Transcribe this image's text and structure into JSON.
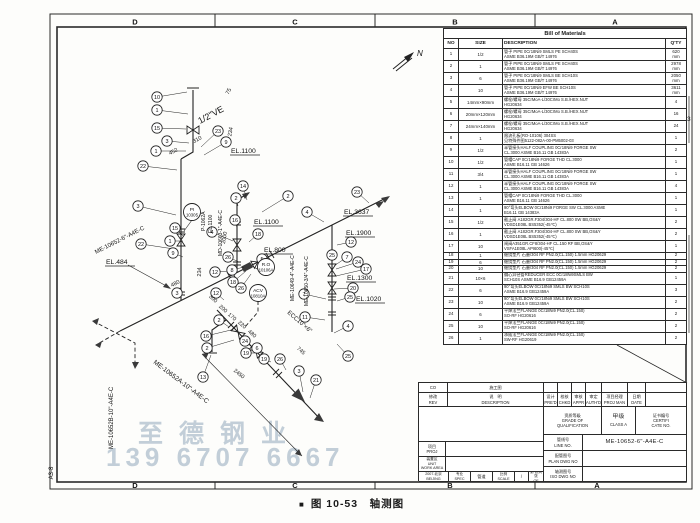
{
  "sheet": {
    "zones_top": [
      "D",
      "C",
      "B",
      "A"
    ],
    "zones_bottom": [
      "D",
      "C",
      "B",
      "A"
    ],
    "sheet_label": "A3-8",
    "north_label": "N",
    "caption_marker": "■",
    "caption": "图 10-53　轴测图"
  },
  "watermark": {
    "line1": "至德钢业",
    "line2": "139 6707 6667",
    "color": "#9eb2c2"
  },
  "bom": {
    "title": "Bill  of  Materials",
    "headers": [
      "NO",
      "SIZE",
      "DESCRIPTION",
      "Q'TY"
    ],
    "rows": [
      {
        "no": "1",
        "size": "1/2",
        "d1": "管子 PIPE 0Cr18Ni9 SMLS PE SCH40S",
        "d2": "ASME B36.19M GB/T 14976",
        "qty": "620",
        "u": "mm"
      },
      {
        "no": "2",
        "size": "1",
        "d1": "管子 PIPE 0Cr18Ni9 SMLS PE SCH40S",
        "d2": "ASME B36.19M GB/T 14976",
        "qty": "2978",
        "u": "mm"
      },
      {
        "no": "3",
        "size": "6",
        "d1": "管子 PIPE 0Cr18Ni9 SMLS BE SCH10S",
        "d2": "ASME B36.19M GB/T 14976",
        "qty": "2050",
        "u": "mm"
      },
      {
        "no": "4",
        "size": "10",
        "d1": "管子 PIPE 0Cr18Ni9 EFW BE SCH10S",
        "d2": "ASME B36.19M GB/T 14976",
        "qty": "3611",
        "u": "mm"
      },
      {
        "no": "5",
        "size": "14mm×90mm",
        "d1": "螺栓/螺母 35CrMoA-L/30CrMo S.B./HEX.NUT",
        "d2": "HG20634",
        "qty": "4",
        "u": ""
      },
      {
        "no": "6",
        "size": "20mm×120mm",
        "d1": "螺栓/螺母 35CrMoA-L/30CrMo S.B./HEX.NUT",
        "d2": "HG20634",
        "qty": "16",
        "u": ""
      },
      {
        "no": "7",
        "size": "24mm×140mm",
        "d1": "螺栓/螺母 35CrMoA-L/30CrMo S.B./HEX.NUT",
        "d2": "HG20634",
        "qty": "24",
        "u": ""
      },
      {
        "no": "8",
        "size": "1",
        "d1": "限流孔板(RO-10106) 304SS",
        "d2": "见特殊件图5122-082A-00-PM5002-03",
        "qty": "1",
        "u": ""
      },
      {
        "no": "9",
        "size": "1/2",
        "d1": "半管接头HALF COUPLING 0Cr18Ni9 FORGE SW",
        "d2": "CL.3000  ASME B16.11 GB 14383A",
        "qty": "2",
        "u": ""
      },
      {
        "no": "10",
        "size": "1/2",
        "d1": "管帽CAP 0Cr18Ni9 FORGE THD CL.3000",
        "d2": "ASME B16.11 GB 14626",
        "qty": "1",
        "u": ""
      },
      {
        "no": "11",
        "size": "3/4",
        "d1": "半管接头HALF COUPLING 0Cr18Ni9 FORGE SW",
        "d2": "CL.3000  ASME B16.11 GB 14383A",
        "qty": "1",
        "u": ""
      },
      {
        "no": "12",
        "size": "1",
        "d1": "半管接头HALF COUPLING 0Cr18Ni9 FORGE SW",
        "d2": "CL.3000  ASME B16.11 GB 14383A",
        "qty": "4",
        "u": ""
      },
      {
        "no": "13",
        "size": "1",
        "d1": "管帽CAP 0Cr18Ni9 FORGE THD CL.3000",
        "d2": "ASME B16.11 GB 14626",
        "qty": "1",
        "u": ""
      },
      {
        "no": "14",
        "size": "1",
        "d1": "90°弯头ELBOW 0Cr18Ni9 FORGE SW CL.3000 ASME",
        "d2": "B16.11 GB 14383A",
        "qty": "1",
        "u": ""
      },
      {
        "no": "15",
        "size": "1/2",
        "d1": "截止阀 A182GR.F304/304-HF CL.800 SW BB,OS&Y",
        "d2": "VDSD1E08L BS5352(-45℃)",
        "qty": "2",
        "u": ""
      },
      {
        "no": "16",
        "size": "1",
        "d1": "截止阀 A182GR.F304/304-HF CL.800 SW BB,OS&Y",
        "d2": "VDSD1E08L BS5352(-45℃)",
        "qty": "2",
        "u": ""
      },
      {
        "no": "17",
        "size": "10",
        "d1": "闸阀A351GR.CF8/304-HF CL.150 RF BB,OS&Y",
        "d2": "VSFA1E08L API600(-45℃)",
        "qty": "1",
        "u": ""
      },
      {
        "no": "18",
        "size": "1",
        "d1": "缠绕垫片 石墨/304 RF PN2.0(CL.150) 1.5mm HG20629",
        "d2": "",
        "qty": "2",
        "u": ""
      },
      {
        "no": "19",
        "size": "6",
        "d1": "缠绕垫片 石墨/304 RF PN2.0(CL.150) 1.5mm HG20629",
        "d2": "",
        "qty": "2",
        "u": ""
      },
      {
        "no": "20",
        "size": "10",
        "d1": "缠绕垫片 石墨/304 RF PN2.0(CL.150) 1.5mm HG20629",
        "d2": "",
        "qty": "2",
        "u": ""
      },
      {
        "no": "21",
        "size": "10×6",
        "d1": "偏心异径管REDUCER ECC 0Cr18Ni9SMLS BW",
        "d2": "SCH10S ASME B16.9 GB12459A",
        "qty": "1",
        "u": ""
      },
      {
        "no": "22",
        "size": "6",
        "d1": "90°弯头ELBOW 0Cr18Ni9 SMLS BW SCH10S",
        "d2": "ASME B16.9 GB12459A",
        "qty": "3",
        "u": ""
      },
      {
        "no": "23",
        "size": "10",
        "d1": "90°弯头ELBOW 0Cr18Ni9 SMLS BW SCH10S",
        "d2": "ASME B16.9 GB12459A",
        "qty": "2",
        "u": ""
      },
      {
        "no": "24",
        "size": "6",
        "d1": "平焊法兰FLANGE 0Cr18Ni9 PN2.0(CL.150)",
        "d2": "SO-RF HG20616",
        "qty": "2",
        "u": ""
      },
      {
        "no": "25",
        "size": "10",
        "d1": "平焊法兰FLANGE 0Cr18Ni9 PN2.0(CL.150)",
        "d2": "SO-RF HG20616",
        "qty": "2",
        "u": ""
      },
      {
        "no": "26",
        "size": "1",
        "d1": "承插法兰FLANGE 0Cr18Ni9 PN2.0(CL.150)",
        "d2": "SW-RF HG20619",
        "qty": "2",
        "u": ""
      }
    ],
    "margin_marks": [
      {
        "text": "3",
        "x": 687,
        "y": 121
      },
      {
        "text": "2",
        "x": 682,
        "y": 289
      }
    ]
  },
  "title_block": {
    "co": "CO",
    "row1_desc": "施工图",
    "rev_cn": "修改",
    "rev_en": "REV",
    "desc_cn": "说　明",
    "desc_en": "DESCRIPTION",
    "sign_cols": [
      {
        "cn": "设计",
        "en": "PRE'D"
      },
      {
        "cn": "校核",
        "en": "CHKD"
      },
      {
        "cn": "审核",
        "en": "APPR"
      },
      {
        "cn": "审定",
        "en": "AUTH'D"
      },
      {
        "cn": "项目经理",
        "en": "PROJ MAN"
      },
      {
        "cn": "日期",
        "en": "DATE"
      }
    ],
    "grade_cn": "资质等级",
    "grade_en1": "GRADE OF",
    "grade_en2": "QUALIFICATION",
    "class_cn": "甲级",
    "class_en": "CLASS A",
    "cert_cn": "证书编号",
    "cert_en1": "CERTIFI",
    "cert_en2": "CATE NO.",
    "line_no_cn": "管线号",
    "line_no_en": "LINE NO.",
    "line_no_value": "ME-10652-6\"-A4E-C",
    "plan_cn": "配管图号",
    "plan_en": "PLAN DWG NO",
    "plan_value": "",
    "iso_cn": "轴测图号",
    "iso_en": "ISO DWG NO",
    "iso_value": "",
    "proj_cn": "项目",
    "proj_en": "PROJ",
    "unit_cn": "装置区",
    "unit_en1": "UNIT",
    "unit_en2": "WORK AREA",
    "org_cn": "2007.北京",
    "org_en": "BEIJING",
    "spec_cn": "专业",
    "spec_en": "SPEC",
    "spec_value": "管道",
    "scale_cn": "比例",
    "scale_en": "SCALE",
    "scale_value": "/",
    "of_cn": "第 张共 张",
    "of_en": "OF"
  },
  "drawing": {
    "balloons": [
      {
        "n": "10",
        "x": 157,
        "y": 97,
        "tx": 187,
        "ty": 92
      },
      {
        "n": "1",
        "x": 157,
        "y": 110,
        "tx": 188,
        "ty": 114
      },
      {
        "n": "15",
        "x": 157,
        "y": 128,
        "tx": 186,
        "ty": 129
      },
      {
        "n": "3",
        "x": 167,
        "y": 141,
        "tx": 189,
        "ty": 143
      },
      {
        "n": "1",
        "x": 156,
        "y": 151,
        "tx": 186,
        "ty": 151
      },
      {
        "n": "23",
        "x": 218,
        "y": 131,
        "tx": 201,
        "ty": 147
      },
      {
        "n": "9",
        "x": 226,
        "y": 142,
        "tx": 204,
        "ty": 155
      },
      {
        "n": "22",
        "x": 143,
        "y": 166,
        "tx": 177,
        "ty": 170
      },
      {
        "n": "2",
        "x": 236,
        "y": 198,
        "tx": 238,
        "ty": 206
      },
      {
        "n": "14",
        "x": 243,
        "y": 186,
        "tx": 247,
        "ty": 200
      },
      {
        "n": "2",
        "x": 288,
        "y": 196,
        "tx": 262,
        "ty": 212
      },
      {
        "n": "3",
        "x": 138,
        "y": 206,
        "tx": 176,
        "ty": 215
      },
      {
        "n": "15",
        "x": 175,
        "y": 228,
        "tx": 183,
        "ty": 236
      },
      {
        "n": "1",
        "x": 170,
        "y": 241,
        "tx": 183,
        "ty": 241
      },
      {
        "n": "22",
        "x": 141,
        "y": 244,
        "tx": 174,
        "ty": 249
      },
      {
        "n": "9",
        "x": 173,
        "y": 253,
        "tx": 183,
        "ty": 257
      },
      {
        "n": "4",
        "x": 212,
        "y": 232,
        "tx": 233,
        "ty": 241
      },
      {
        "n": "16",
        "x": 235,
        "y": 220,
        "tx": 237,
        "ty": 228
      },
      {
        "n": "18",
        "x": 258,
        "y": 234,
        "tx": 249,
        "ty": 242
      },
      {
        "n": "26",
        "x": 228,
        "y": 257,
        "tx": 239,
        "ty": 262
      },
      {
        "n": "5",
        "x": 262,
        "y": 259,
        "tx": 254,
        "ty": 264
      },
      {
        "n": "12",
        "x": 215,
        "y": 272,
        "tx": 229,
        "ty": 271
      },
      {
        "n": "8",
        "x": 232,
        "y": 270,
        "tx": 244,
        "ty": 267
      },
      {
        "n": "18",
        "x": 233,
        "y": 282,
        "tx": 246,
        "ty": 271
      },
      {
        "n": "26",
        "x": 241,
        "y": 288,
        "tx": 251,
        "ty": 274
      },
      {
        "n": "3",
        "x": 177,
        "y": 293,
        "tx": 181,
        "ty": 287
      },
      {
        "n": "12",
        "x": 216,
        "y": 293,
        "tx": 224,
        "ty": 300
      },
      {
        "n": "2",
        "x": 219,
        "y": 320,
        "tx": 229,
        "ty": 327
      },
      {
        "n": "23",
        "x": 357,
        "y": 192,
        "tx": 369,
        "ty": 203
      },
      {
        "n": "4",
        "x": 307,
        "y": 212,
        "tx": 324,
        "ty": 222
      },
      {
        "n": "12",
        "x": 351,
        "y": 242,
        "tx": 337,
        "ty": 245
      },
      {
        "n": "25",
        "x": 332,
        "y": 255,
        "tx": 332,
        "ty": 262
      },
      {
        "n": "7",
        "x": 347,
        "y": 257,
        "tx": 334,
        "ty": 266
      },
      {
        "n": "24",
        "x": 358,
        "y": 262,
        "tx": 336,
        "ty": 269
      },
      {
        "n": "17",
        "x": 366,
        "y": 269,
        "tx": 336,
        "ty": 276
      },
      {
        "n": "20",
        "x": 353,
        "y": 288,
        "tx": 334,
        "ty": 289
      },
      {
        "n": "7",
        "x": 304,
        "y": 294,
        "tx": 326,
        "ty": 299
      },
      {
        "n": "25",
        "x": 350,
        "y": 297,
        "tx": 337,
        "ty": 301
      },
      {
        "n": "11",
        "x": 305,
        "y": 317,
        "tx": 325,
        "ty": 320
      },
      {
        "n": "4",
        "x": 348,
        "y": 326,
        "tx": 334,
        "ty": 333
      },
      {
        "n": "25",
        "x": 348,
        "y": 356,
        "tx": 337,
        "ty": 344
      },
      {
        "n": "16",
        "x": 206,
        "y": 336,
        "tx": 231,
        "ty": 330
      },
      {
        "n": "2",
        "x": 207,
        "y": 348,
        "tx": 234,
        "ty": 340
      },
      {
        "n": "13",
        "x": 203,
        "y": 377,
        "tx": 211,
        "ty": 355
      },
      {
        "n": "24",
        "x": 245,
        "y": 341,
        "tx": 256,
        "ty": 351
      },
      {
        "n": "19",
        "x": 246,
        "y": 353,
        "tx": 259,
        "ty": 353
      },
      {
        "n": "6",
        "x": 257,
        "y": 348,
        "tx": 263,
        "ty": 356
      },
      {
        "n": "19",
        "x": 264,
        "y": 359,
        "tx": 271,
        "ty": 362
      },
      {
        "n": "26",
        "x": 280,
        "y": 359,
        "tx": 286,
        "ty": 370
      },
      {
        "n": "3",
        "x": 299,
        "y": 371,
        "tx": 303,
        "ty": 392
      },
      {
        "n": "21",
        "x": 316,
        "y": 380,
        "tx": 310,
        "ty": 398
      }
    ],
    "elevations": [
      {
        "t": "EL.1100",
        "x": 231,
        "y": 153
      },
      {
        "t": "EL.1100",
        "x": 254,
        "y": 224
      },
      {
        "t": "EL.800",
        "x": 264,
        "y": 252
      },
      {
        "t": "EL.484",
        "x": 106,
        "y": 264
      },
      {
        "t": "EL.3637",
        "x": 344,
        "y": 214
      },
      {
        "t": "EL.1900",
        "x": 346,
        "y": 235
      },
      {
        "t": "EL.1300",
        "x": 347,
        "y": 280
      },
      {
        "t": "EL.1020",
        "x": 356,
        "y": 301
      }
    ],
    "line_labels": [
      {
        "t": "ME-10652-6\"-A4E-C",
        "x": 96,
        "y": 254,
        "r": -27,
        "s": 6
      },
      {
        "t": "ME-10652A-10\"-A4E-C",
        "x": 153,
        "y": 363,
        "r": 37,
        "s": 6.5
      },
      {
        "t": "ME-10652B-10\"-A4E-C",
        "x": 113,
        "y": 449,
        "r": -90,
        "s": 6
      },
      {
        "t": "P-1062A",
        "x": 205,
        "y": 231,
        "r": -90,
        "s": 5
      },
      {
        "t": "EL.1100",
        "x": 212,
        "y": 233,
        "r": -90,
        "s": 5
      },
      {
        "t": "MD-10663-1\"-A4E-C",
        "x": 222,
        "y": 256,
        "r": -90,
        "s": 5
      },
      {
        "t": "ME-10649-4\"-A4E-C",
        "x": 294,
        "y": 301,
        "r": -90,
        "s": 5
      },
      {
        "t": "ME-10650-3/4\"-A4E-C",
        "x": 308,
        "y": 306,
        "r": -90,
        "s": 5
      },
      {
        "t": "ECC10\"×6\"",
        "x": 287,
        "y": 313,
        "r": 41,
        "s": 6
      },
      {
        "t": "1/2\"VE",
        "x": 200,
        "y": 124,
        "r": -28,
        "s": 9
      }
    ],
    "dimensions": [
      {
        "t": "75",
        "x": 230,
        "y": 92,
        "r": -62
      },
      {
        "t": "234",
        "x": 232,
        "y": 132,
        "r": -80
      },
      {
        "t": "310",
        "x": 198,
        "y": 141,
        "r": -28
      },
      {
        "t": "452",
        "x": 174,
        "y": 153,
        "r": -28
      },
      {
        "t": "2000",
        "x": 226,
        "y": 238,
        "r": -80
      },
      {
        "t": "234",
        "x": 201,
        "y": 272,
        "r": -88
      },
      {
        "t": "480",
        "x": 176,
        "y": 285,
        "r": -27
      },
      {
        "t": "300",
        "x": 212,
        "y": 300,
        "r": 41
      },
      {
        "t": "200",
        "x": 222,
        "y": 310,
        "r": 41
      },
      {
        "t": "170",
        "x": 231,
        "y": 318,
        "r": 41
      },
      {
        "t": "220",
        "x": 241,
        "y": 326,
        "r": 41
      },
      {
        "t": "480",
        "x": 251,
        "y": 335,
        "r": 41
      },
      {
        "t": "745",
        "x": 300,
        "y": 352,
        "r": 41
      },
      {
        "t": "2450",
        "x": 238,
        "y": 375,
        "r": 39
      }
    ],
    "instrument_bubbles": [
      {
        "l1": "PI",
        "l2": "10305",
        "x": 192,
        "y": 212
      },
      {
        "l1": "R.O",
        "l2": "10106A",
        "x": 266,
        "y": 267
      },
      {
        "l1": "ACV",
        "l2": "10810A",
        "x": 258,
        "y": 293
      }
    ]
  }
}
